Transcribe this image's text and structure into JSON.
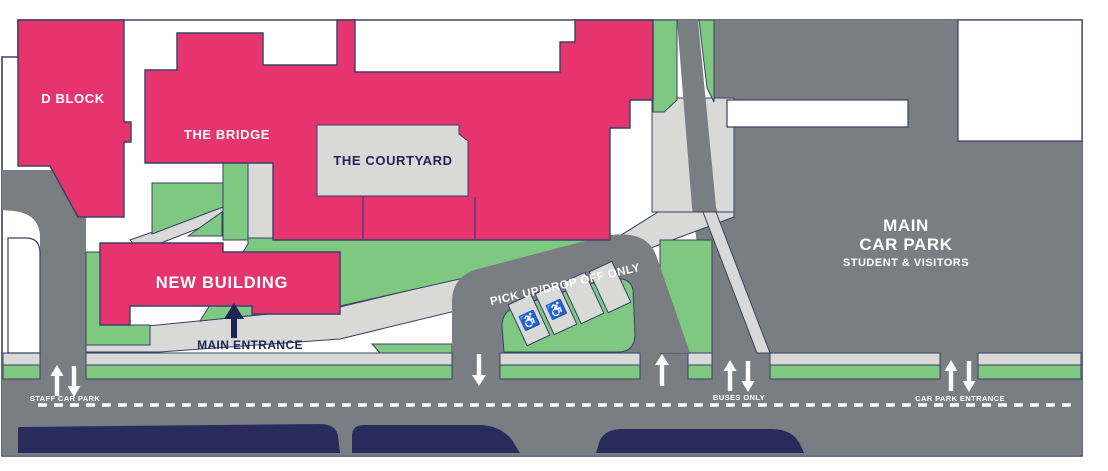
{
  "map": {
    "buildings": {
      "d_block": "D BLOCK",
      "the_bridge": "THE BRIDGE",
      "the_courtyard": "THE COURTYARD",
      "new_building": "NEW BUILDING",
      "main_car_park_line1": "MAIN",
      "main_car_park_line2": "CAR PARK",
      "main_car_park_line3": "STUDENT & VISITORS"
    },
    "annotations": {
      "main_entrance": "MAIN ENTRANCE",
      "pick_up_drop_off": "PICK UP/DROP OFF ONLY",
      "staff_car_park": "STAFF CAR PARK",
      "buses_only": "BUSES ONLY",
      "car_park_entrance": "CAR PARK ENTRANCE"
    },
    "icons": {
      "wheelchair_glyph": "♿"
    },
    "colors": {
      "building_pink": "#E5346E",
      "grass_green": "#7EC882",
      "road_gray": "#7A7E82",
      "path_gray": "#D9D9D7",
      "outline_navy": "#3A4066",
      "south_block_navy": "#2A2B5D",
      "label_navy": "#1E2456",
      "label_white": "#FFFFFF"
    }
  }
}
